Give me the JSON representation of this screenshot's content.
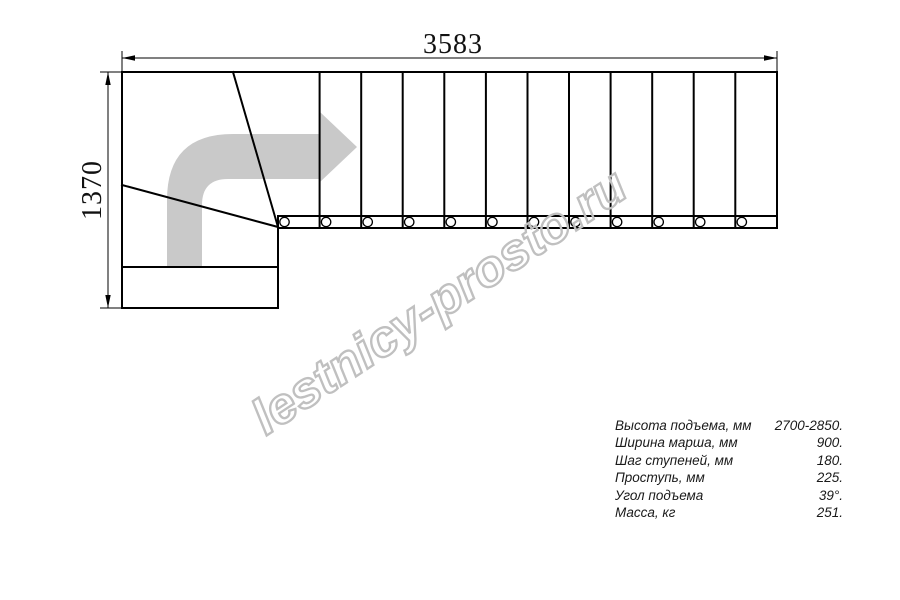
{
  "drawing": {
    "dim_width_label": "3583",
    "dim_height_label": "1370"
  },
  "watermark": {
    "text": "lestnicy-prosto.ru"
  },
  "specs": {
    "rows": [
      {
        "label": "Высота подъема, мм",
        "value": "2700-2850."
      },
      {
        "label": "Ширина марша, мм",
        "value": "900."
      },
      {
        "label": "Шаг ступеней, мм",
        "value": "180."
      },
      {
        "label": "Проступь, мм",
        "value": "225."
      },
      {
        "label": "Угол подъема",
        "value": "39°."
      },
      {
        "label": "Масса, кг",
        "value": "251."
      }
    ]
  },
  "colors": {
    "line": "#000000",
    "arrow_fill": "#c9c9c9",
    "watermark_stroke": "#c0c0c0"
  }
}
